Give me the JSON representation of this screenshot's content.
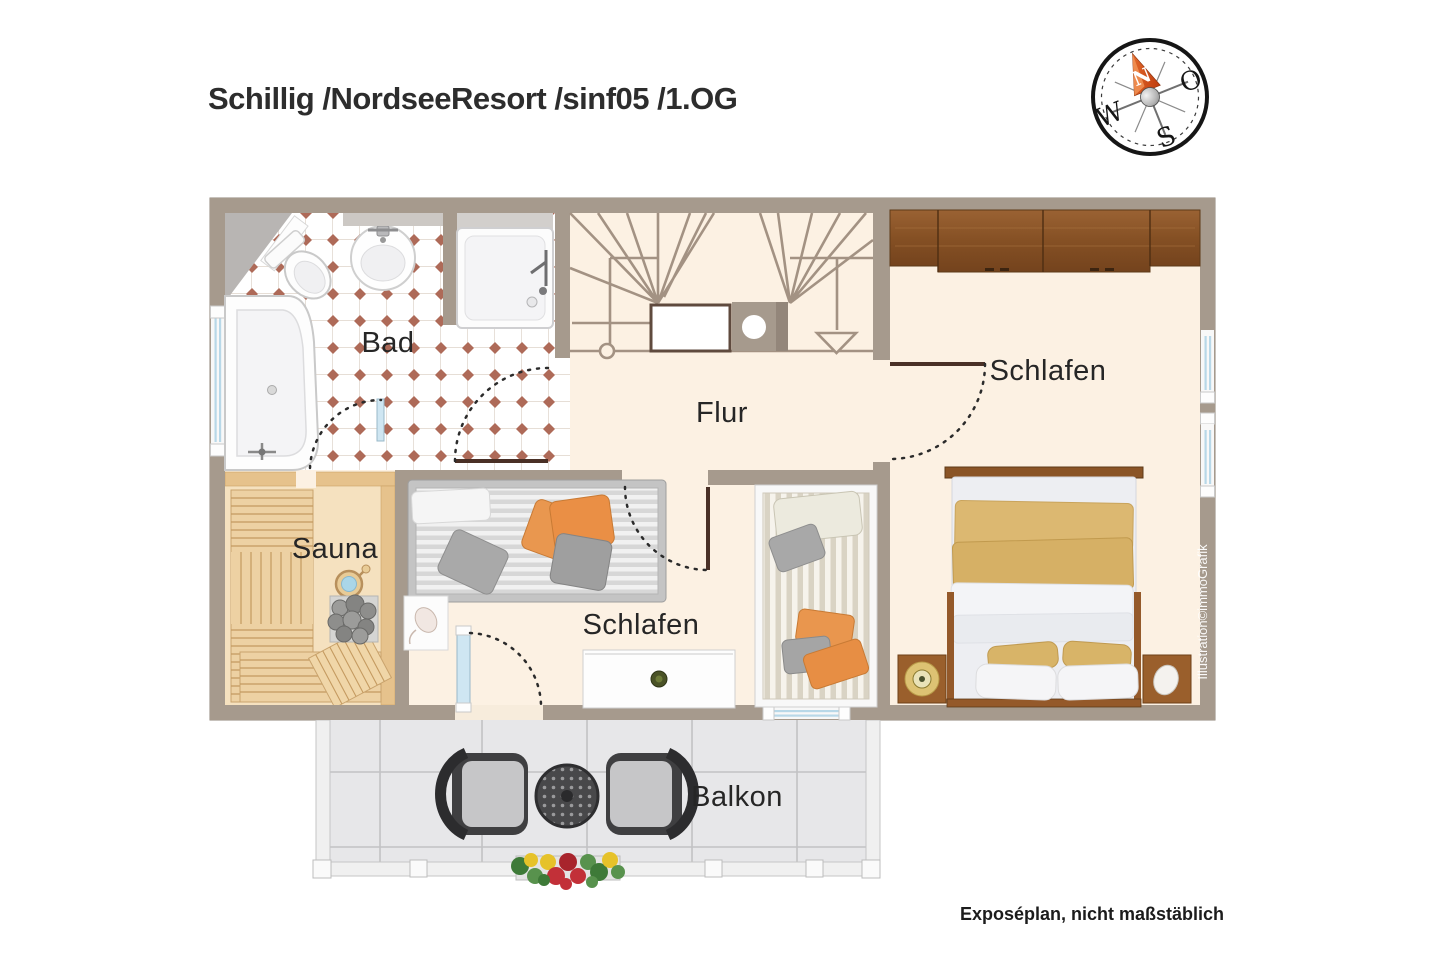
{
  "header": {
    "title": "Schillig /NordseeResort /sinf05 /1.OG"
  },
  "compass": {
    "north": "N",
    "east": "O",
    "south": "S",
    "west": "W"
  },
  "rooms": {
    "bad": {
      "label": "Bad"
    },
    "flur": {
      "label": "Flur"
    },
    "schlafen_top": {
      "label": "Schlafen"
    },
    "sauna": {
      "label": "Sauna"
    },
    "schlafen_bottom": {
      "label": "Schlafen"
    },
    "balkon": {
      "label": "Balkon"
    }
  },
  "footer": {
    "note": "Exposéplan, nicht maßstäblich",
    "watermark": "Illustration©immoGrafik"
  },
  "colors": {
    "wall": "#a69a8d",
    "floor": "#fcf1e3",
    "tile_dot": "#ae6a58",
    "sauna_wood": "#e6c28c",
    "wardrobe_wood": "#8a5426",
    "accent_orange": "#e9964e",
    "blanket_tan": "#dcb871",
    "compass_needle": "#d2491e",
    "window_glass": "#b8d8e8",
    "balcony_tile": "#e7e7e9"
  }
}
